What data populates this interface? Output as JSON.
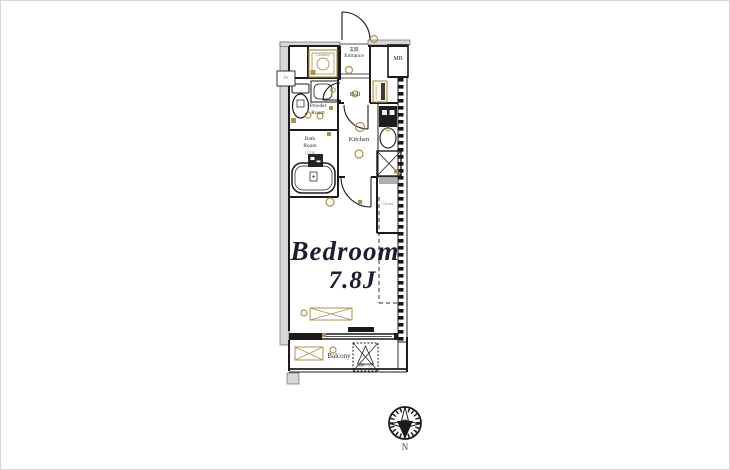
{
  "floor_plan": {
    "rooms": {
      "entrance": {
        "label_jp": "玄関",
        "label": "Entrance"
      },
      "mb": {
        "label": "MB"
      },
      "laundry": {
        "label": "Laundry"
      },
      "ps": {
        "label": "PS"
      },
      "hall": {
        "label": "Hall"
      },
      "shoes_box": {
        "label": "Shoes box"
      },
      "powder_room": {
        "line1": "Powder",
        "line2": "Room"
      },
      "bath_room": {
        "line1": "Bath",
        "line2": "Room",
        "size": "(1116)"
      },
      "kitchen": {
        "label": "Kitchen"
      },
      "closet": {
        "label": "Closet"
      },
      "bedroom": {
        "name": "Bedroom",
        "size": "7.8J"
      },
      "balcony": {
        "label": "Balcony"
      },
      "evacuation_hatch": {
        "label": "避難ハッチ"
      }
    },
    "compass": {
      "label": "N"
    },
    "colors": {
      "wall": "#1b1b1b",
      "accent": "#a9924d",
      "neighbor_gray": "#d8d8d8",
      "bedroom_text": "#1d1d30"
    }
  }
}
